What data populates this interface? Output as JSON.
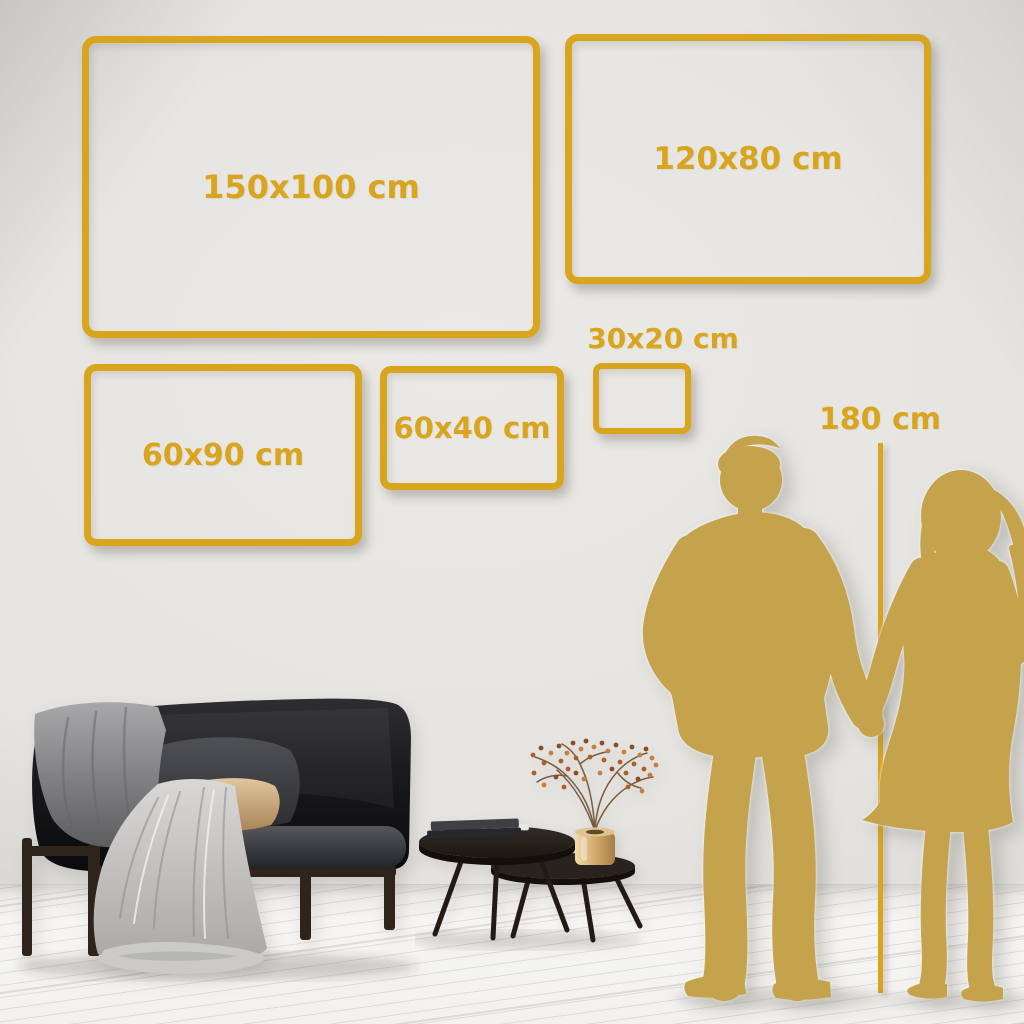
{
  "theme": {
    "accent_gold": "#d9a51e",
    "silhouette_gold": "#c5a24c",
    "wall_color": "#e6e4e1",
    "floor_color": "#f6f5f3",
    "sofa_color": "#141416",
    "pillow_beige": "#d3b184",
    "blanket_gray": "#c8c7c5",
    "vase_gold": "#d2ab6e",
    "plant_rust": "#ad5f26",
    "wood_dark": "#2e241c"
  },
  "size_guide": {
    "unit": "cm",
    "frames": [
      {
        "label": "150x100 cm",
        "width_cm": 150,
        "height_cm": 100
      },
      {
        "label": "120x80 cm",
        "width_cm": 120,
        "height_cm": 80
      },
      {
        "label": "60x90 cm",
        "width_cm": 60,
        "height_cm": 90
      },
      {
        "label": "60x40 cm",
        "width_cm": 60,
        "height_cm": 40
      },
      {
        "label": "30x20 cm",
        "width_cm": 30,
        "height_cm": 20
      }
    ],
    "reference": {
      "label": "180 cm",
      "height_cm": 180
    }
  },
  "scene": {
    "illustrations": [
      "couple-silhouette",
      "height-line",
      "sofa",
      "blanket",
      "pillows",
      "nesting-coffee-tables",
      "books",
      "gold-vase",
      "dried-plant",
      "plank-floor"
    ]
  }
}
